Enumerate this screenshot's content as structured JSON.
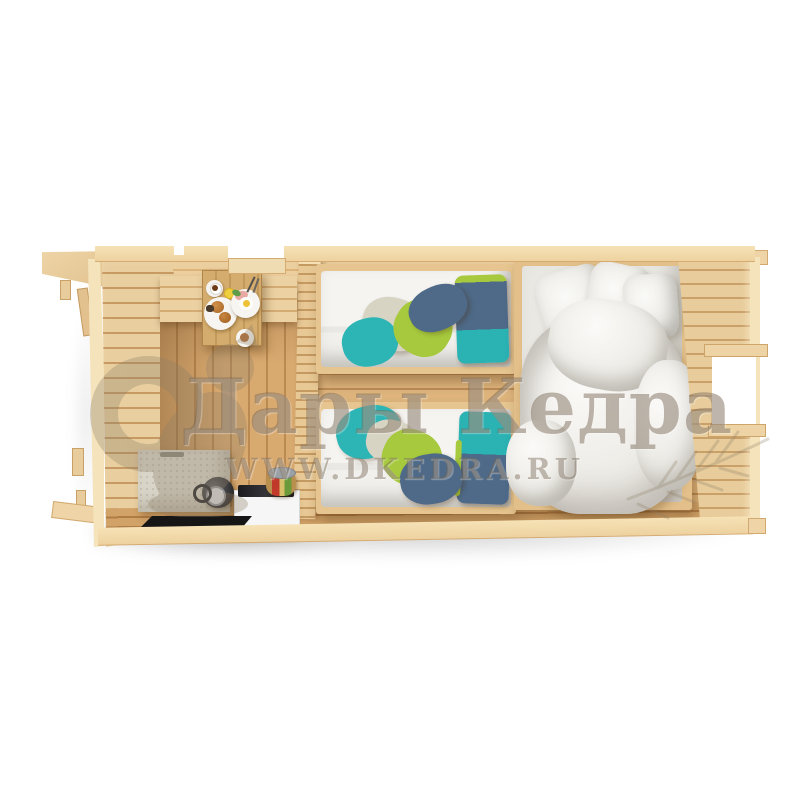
{
  "scene": {
    "type": "3d-render-top-down-cutaway",
    "subject": "three-room wooden garden cabin with furniture",
    "background_color": "#ffffff"
  },
  "watermark": {
    "brand": "Дары Кедра",
    "website": "WWW.DKEDRA.RU",
    "text_color": "#6f5e4a",
    "logo": "squirrel-logo",
    "decor": "cedar-branch"
  },
  "palette": {
    "wood_cut_edge": "#f3dcae",
    "wood_wall": "#e3bd85",
    "wood_floor": "#d9ad74",
    "counter_gray": "#d9d5c9",
    "appliance_white": "#f6f6f6",
    "appliance_black": "#202024",
    "mat_black": "#161616",
    "mattress_white": "#f3f2ef",
    "duvet_white": "#f7f6f3",
    "blanket_teal": "#2db4b5",
    "blanket_lime": "#a6c93d",
    "blanket_slate": "#4e6a88",
    "blanket_pale": "#d8d4c4"
  },
  "rooms": [
    {
      "id": "kitchen-dining",
      "label": "kitchen and dining room",
      "furniture": [
        "wall bench",
        "breakfast table",
        "plate with croissants",
        "plate with fried egg and ham",
        "coffee cup",
        "lemon slice",
        "dessert plate",
        "stone worktop",
        "black kettle",
        "white cabinet with hob",
        "vegetable jar",
        "black floor mat"
      ]
    },
    {
      "id": "twin-bedroom",
      "label": "bedroom with two single beds",
      "furniture": [
        "single bed top",
        "single bed bottom",
        "two-tone pillow top",
        "two-tone pillow bottom",
        "crumpled blanket top",
        "crumpled blanket bottom"
      ]
    },
    {
      "id": "double-bedroom",
      "label": "bedroom with double bed",
      "furniture": [
        "double bed",
        "white pillows",
        "crumpled white duvet",
        "window in right wall"
      ]
    }
  ],
  "exterior": [
    "porch roof overhang",
    "porch post",
    "entrance door opening",
    "left wall posts",
    "right roof eave"
  ]
}
